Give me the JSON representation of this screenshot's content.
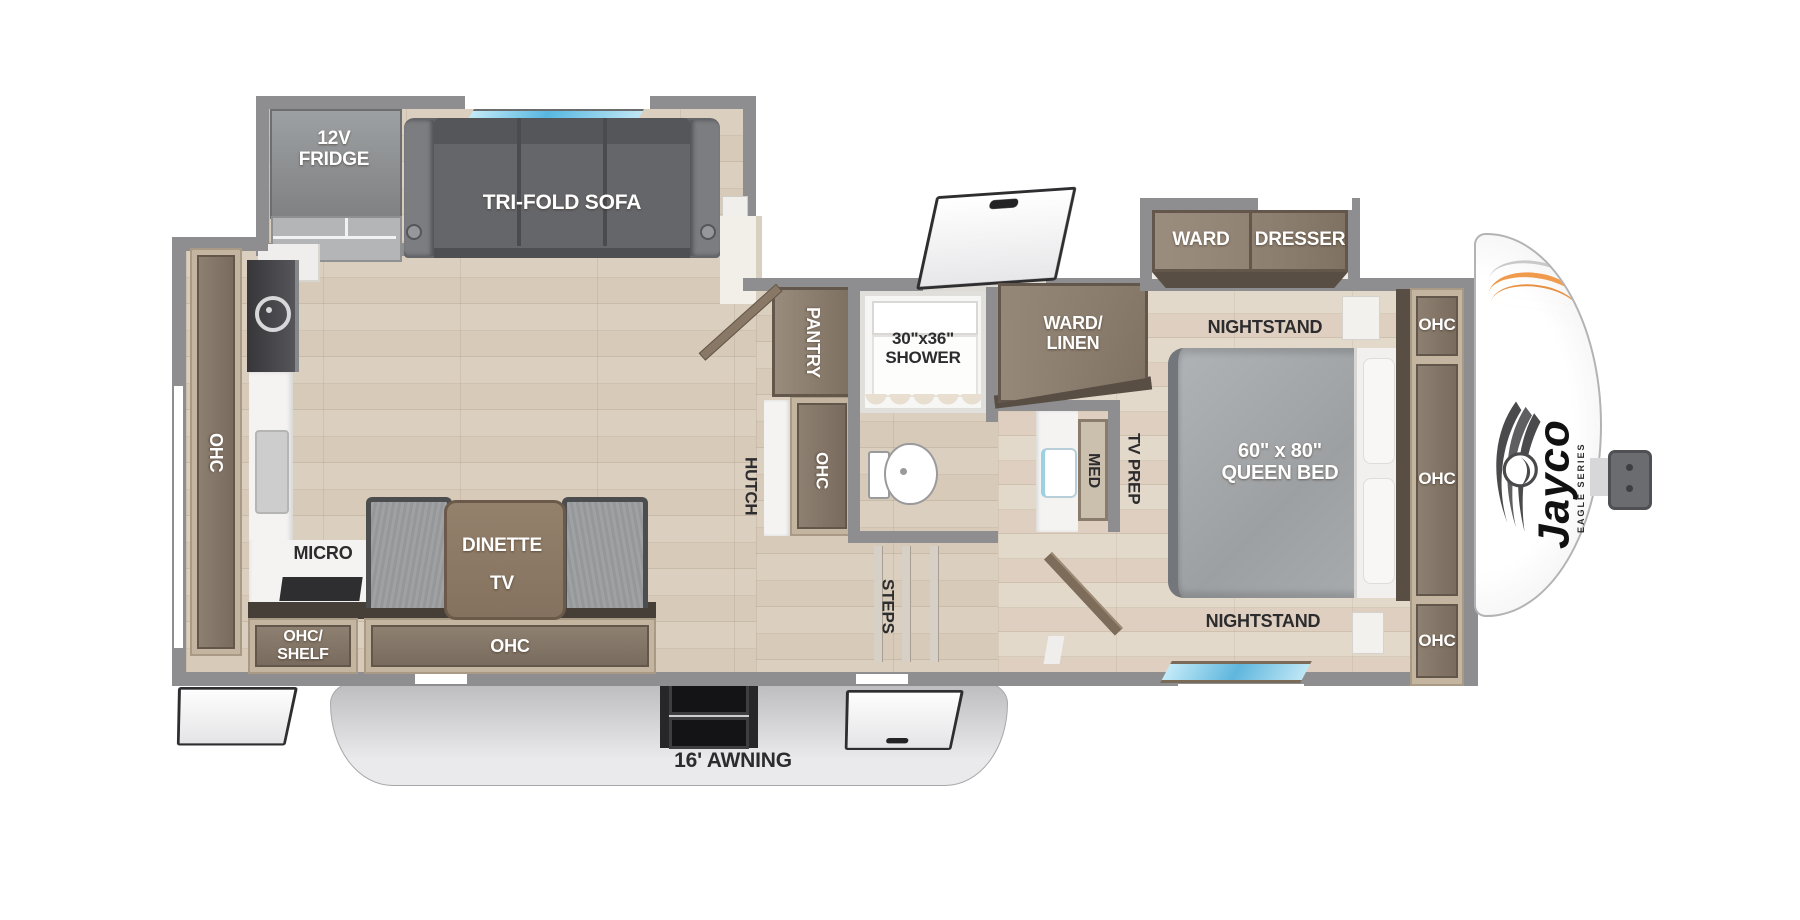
{
  "plan": {
    "slide_left": {
      "fridge_label": "12V\nFRIDGE",
      "sofa_label": "TRI-FOLD SOFA"
    },
    "kitchen": {
      "wall_cabinet_label": "OHC",
      "micro_label": "MICRO",
      "shelf_cabinet_label": "OHC/\nSHELF",
      "lower_cabinet_label": "OHC"
    },
    "dinette": {
      "label": "DINETTE",
      "tv_label": "TV"
    },
    "hutch": {
      "label": "HUTCH",
      "cabinet_label": "OHC",
      "pantry_label": "PANTRY"
    },
    "bath": {
      "shower_label": "30\"x36\"\nSHOWER",
      "ward_linen_label": "WARD/\nLINEN",
      "med_label": "MED"
    },
    "bedroom": {
      "tv_prep_label": "TV PREP",
      "steps_label": "STEPS",
      "nightstand_top_label": "NIGHTSTAND",
      "nightstand_bottom_label": "NIGHTSTAND",
      "bed_label": "60\" x 80\"\nQUEEN BED",
      "ward_label": "WARD",
      "dresser_label": "DRESSER",
      "ohc_top_label": "OHC",
      "ohc_middle_label": "OHC",
      "ohc_bottom_label": "OHC"
    },
    "exterior": {
      "awning_label": "16' AWNING"
    },
    "brand": {
      "name": "Jayco",
      "series": "EAGLE SERIES"
    },
    "colors": {
      "wall": "#8e8e90",
      "floor": "#d9cdbc",
      "bedroom_floor": "#e0d6c6",
      "cabinet_frame": "#c3b5a0",
      "cabinet_panel": "#84766a",
      "sofa_gray": "#6f7072",
      "bed_gray": "#a9acae",
      "counter_white": "#f4f3f1",
      "awning_gray": "#d9d9db",
      "window_blue": "#5fb6dd",
      "accent_orange": "#f09a4d"
    }
  }
}
